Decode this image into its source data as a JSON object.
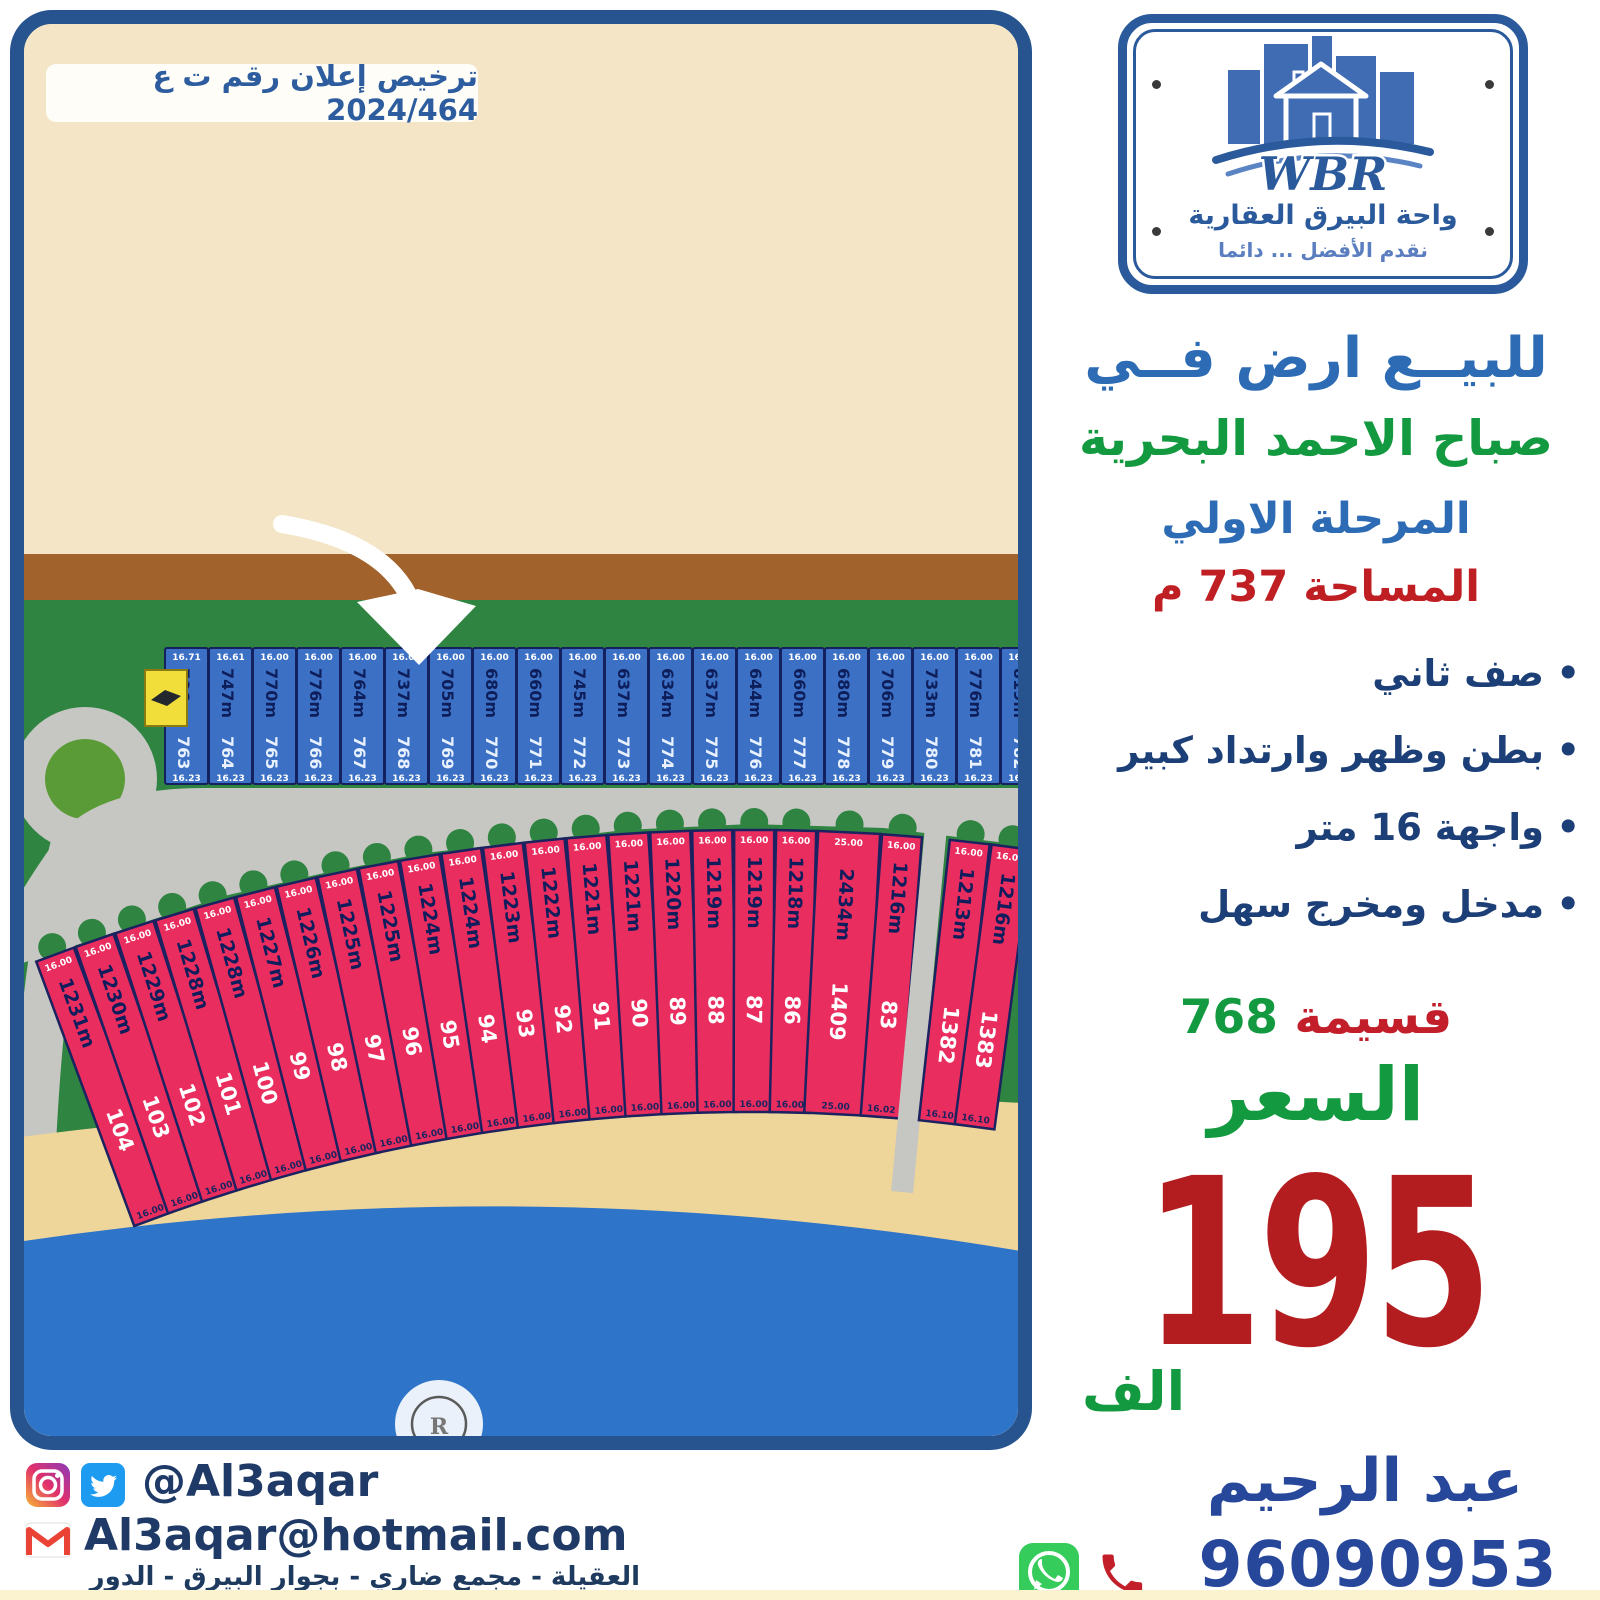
{
  "license": {
    "text": "ترخيص إعلان رقم ت ع 2024/464"
  },
  "logo": {
    "wbr": "WBR",
    "company": "واحة البيرق العقارية",
    "slogan": "نقدم الأفضل ... دائما"
  },
  "headline": {
    "line1": "للبيــع ارض فــي",
    "line2": "صباح الاحمد البحرية",
    "line3": "المرحلة الاولي",
    "line4": "المساحة 737 م"
  },
  "features": [
    "صف ثاني",
    "بطن وظهر وارتداد كبير",
    "واجهة 16 متر",
    "مدخل ومخرج سهل"
  ],
  "parcel": {
    "label": "قسيمة",
    "number": "768"
  },
  "price": {
    "label": "السعر",
    "value": "195",
    "unit": "الف"
  },
  "agent": {
    "name": "عبد الرحيم",
    "phone": "96090953"
  },
  "social": {
    "handle": "@Al3aqar",
    "email": "Al3aqar@hotmail.com"
  },
  "footer": {
    "address": "العقيلة - مجمع ضاري - بجوار البيرق - الدور السادس - مكتب 6"
  },
  "colors": {
    "frame_navy": "#27548f",
    "title_blue": "#2d6cb5",
    "green": "#13993f",
    "red": "#bf1f23",
    "price_red": "#b41d20",
    "contact_navy": "#27479b",
    "sand": "#f3e5c6",
    "brown_road": "#a2622b",
    "grass": "#2e8440",
    "road_gray": "#c6c6c2",
    "beach": "#eed59a",
    "sea": "#2e74c9",
    "blue_plot": "#3b70c4",
    "pink_plot": "#e92e5f",
    "utility_yellow": "#f2de3a"
  },
  "map": {
    "blue_row": {
      "plots": [
        {
          "num": "763",
          "area": "706m",
          "front": "16.71",
          "back": "16.23"
        },
        {
          "num": "764",
          "area": "747m",
          "front": "16.61",
          "back": "16.23"
        },
        {
          "num": "765",
          "area": "770m",
          "front": "16.00",
          "back": "16.23"
        },
        {
          "num": "766",
          "area": "776m",
          "front": "16.00",
          "back": "16.23"
        },
        {
          "num": "767",
          "area": "764m",
          "front": "16.00",
          "back": "16.23"
        },
        {
          "num": "768",
          "area": "737m",
          "front": "16.00",
          "back": "16.23"
        },
        {
          "num": "769",
          "area": "705m",
          "front": "16.00",
          "back": "16.23"
        },
        {
          "num": "770",
          "area": "680m",
          "front": "16.00",
          "back": "16.23"
        },
        {
          "num": "771",
          "area": "660m",
          "front": "16.00",
          "back": "16.23"
        },
        {
          "num": "772",
          "area": "745m",
          "front": "16.00",
          "back": "16.23"
        },
        {
          "num": "773",
          "area": "637m",
          "front": "16.00",
          "back": "16.23"
        },
        {
          "num": "774",
          "area": "634m",
          "front": "16.00",
          "back": "16.23"
        },
        {
          "num": "775",
          "area": "637m",
          "front": "16.00",
          "back": "16.23"
        },
        {
          "num": "776",
          "area": "644m",
          "front": "16.00",
          "back": "16.23"
        },
        {
          "num": "777",
          "area": "660m",
          "front": "16.00",
          "back": "16.23"
        },
        {
          "num": "778",
          "area": "680m",
          "front": "16.00",
          "back": "16.23"
        },
        {
          "num": "779",
          "area": "706m",
          "front": "16.00",
          "back": "16.23"
        },
        {
          "num": "780",
          "area": "733m",
          "front": "16.00",
          "back": "16.23"
        },
        {
          "num": "781",
          "area": "776m",
          "front": "16.00",
          "back": "16.23"
        },
        {
          "num": "782",
          "area": "819m",
          "front": "16.00",
          "back": "16.23"
        }
      ]
    },
    "pink_row": {
      "plots": [
        {
          "num": "104",
          "area": "1231m",
          "front": "16.00",
          "back": "16.00"
        },
        {
          "num": "103",
          "area": "1230m",
          "front": "16.00",
          "back": "16.00"
        },
        {
          "num": "102",
          "area": "1229m",
          "front": "16.00",
          "back": "16.00"
        },
        {
          "num": "101",
          "area": "1228m",
          "front": "16.00",
          "back": "16.00"
        },
        {
          "num": "100",
          "area": "1228m",
          "front": "16.00",
          "back": "16.00"
        },
        {
          "num": "99",
          "area": "1227m",
          "front": "16.00",
          "back": "16.00"
        },
        {
          "num": "98",
          "area": "1226m",
          "front": "16.00",
          "back": "16.00"
        },
        {
          "num": "97",
          "area": "1225m",
          "front": "16.00",
          "back": "16.00"
        },
        {
          "num": "96",
          "area": "1225m",
          "front": "16.00",
          "back": "16.00"
        },
        {
          "num": "95",
          "area": "1224m",
          "front": "16.00",
          "back": "16.00"
        },
        {
          "num": "94",
          "area": "1224m",
          "front": "16.00",
          "back": "16.00"
        },
        {
          "num": "93",
          "area": "1223m",
          "front": "16.00",
          "back": "16.00"
        },
        {
          "num": "92",
          "area": "1222m",
          "front": "16.00",
          "back": "16.00"
        },
        {
          "num": "91",
          "area": "1221m",
          "front": "16.00",
          "back": "16.00"
        },
        {
          "num": "90",
          "area": "1221m",
          "front": "16.00",
          "back": "16.00"
        },
        {
          "num": "89",
          "area": "1220m",
          "front": "16.00",
          "back": "16.00"
        },
        {
          "num": "88",
          "area": "1219m",
          "front": "16.00",
          "back": "16.00"
        },
        {
          "num": "87",
          "area": "1219m",
          "front": "16.00",
          "back": "16.00"
        },
        {
          "num": "86",
          "area": "1218m",
          "front": "16.00",
          "back": "16.00"
        },
        {
          "num": "1409",
          "area": "2434m",
          "front": "25.00",
          "back": "25.00",
          "wide": true
        },
        {
          "num": "83",
          "area": "1216m",
          "front": "16.00",
          "back": "16.02"
        },
        {
          "num": "1382",
          "area": "1213m",
          "front": "16.00",
          "back": "16.10",
          "pier_gap": true
        },
        {
          "num": "1383",
          "area": "1216m",
          "front": "16.00",
          "back": "16.10"
        }
      ]
    }
  }
}
